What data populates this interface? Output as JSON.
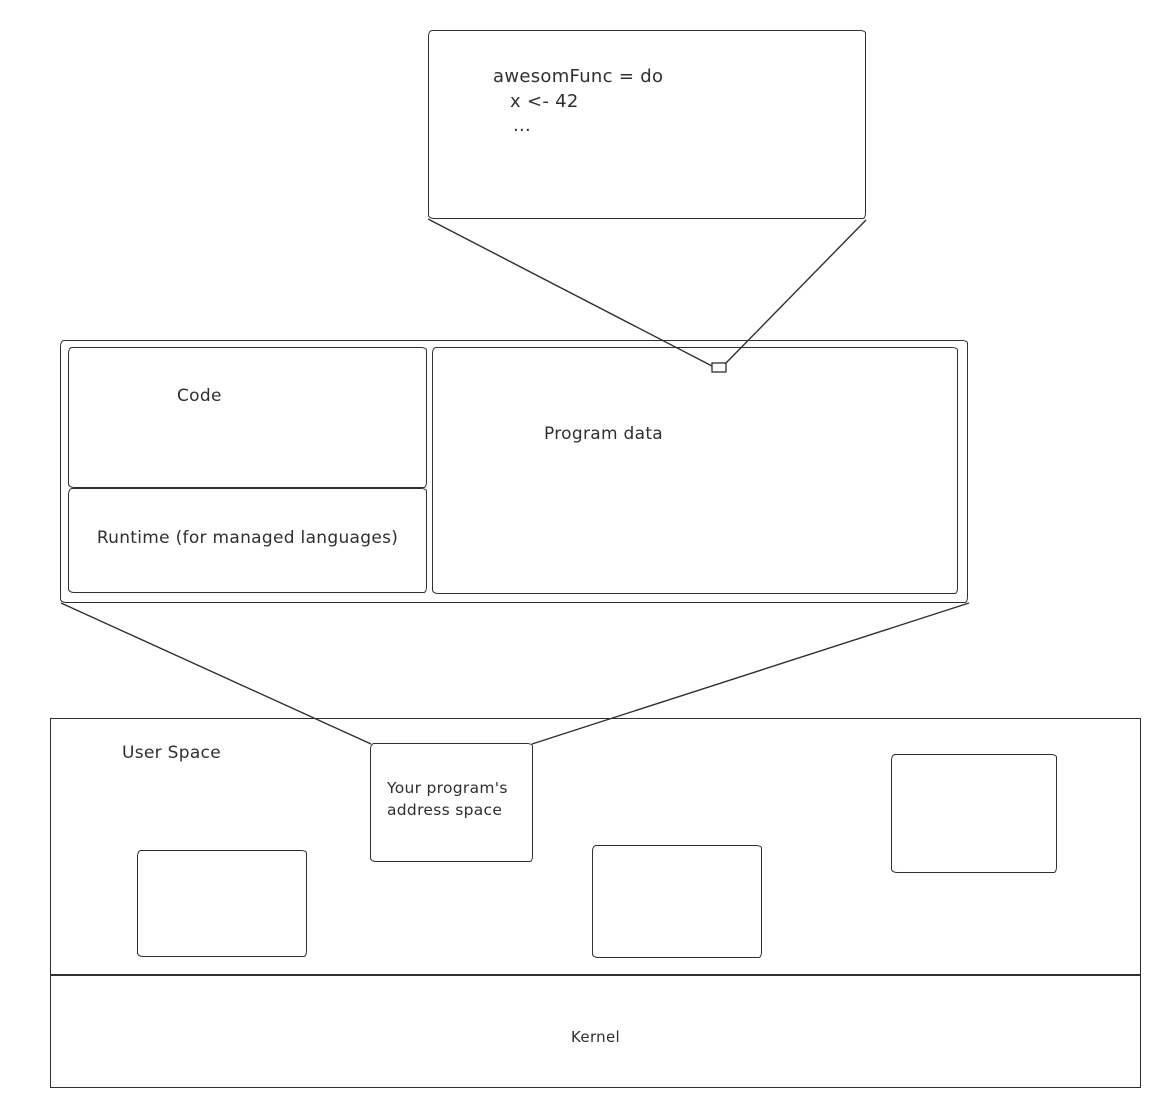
{
  "colors": {
    "stroke": "#2f2f2f",
    "background": "#ffffff"
  },
  "code_snippet_box": {
    "lines": [
      "awesomFunc = do",
      "x <- 42",
      "..."
    ]
  },
  "program_address_space_detail": {
    "code_label": "Code",
    "runtime_label": "Runtime (for managed languages)",
    "program_data_label": "Program data"
  },
  "system_memory": {
    "user_space_label": "User Space",
    "program_box_line1": "Your program's",
    "program_box_line2": "address space",
    "kernel_label": "Kernel"
  }
}
